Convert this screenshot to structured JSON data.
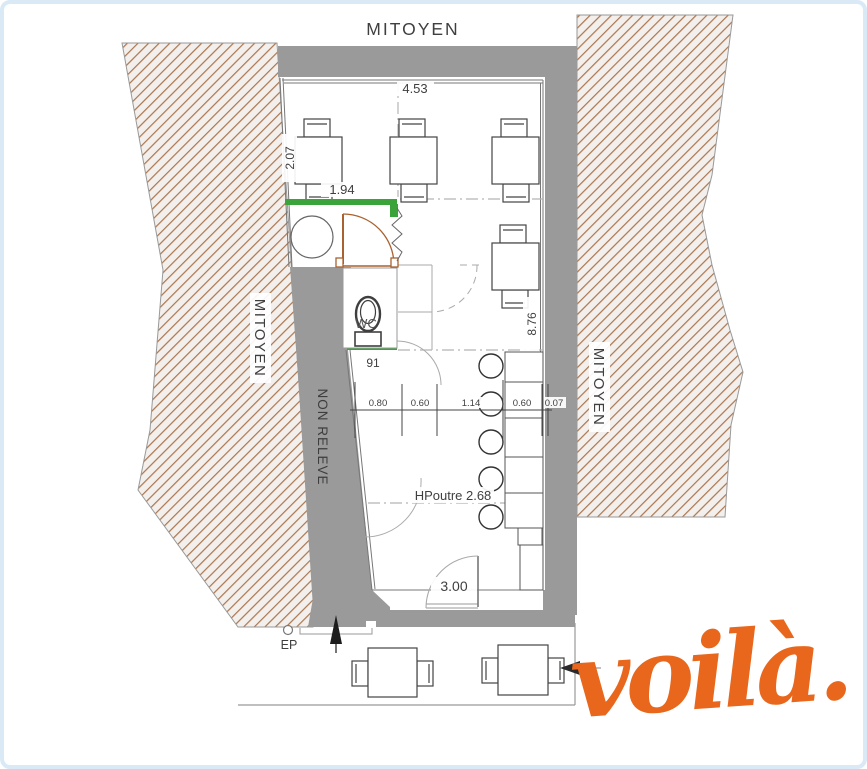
{
  "site_labels": {
    "mitoyen_top": "MITOYEN",
    "mitoyen_left": "MITOYEN",
    "mitoyen_right": "MITOYEN",
    "non_releve": "NON RELEVE"
  },
  "rooms": {
    "wc": "WC"
  },
  "annotations": {
    "hpoutre": "HPoutre 2.68",
    "ep": "EP"
  },
  "dimensions": {
    "top_span": "4.53",
    "left_top": "2.07",
    "green_wall": "1.94",
    "wc_width": "91",
    "right_span": "8.76",
    "entrance": "3.00",
    "chain": [
      "0.80",
      "0.60",
      "1.14",
      "0.60",
      "0.07"
    ]
  },
  "logo": {
    "text": "voilà.",
    "color": "#e8671c"
  },
  "colors": {
    "wall_gray": "#9a9a9a",
    "hatch_line": "#ab764f",
    "hatch_bg": "#f2efec",
    "green_wall": "#3aa43a",
    "door_brown": "#a9622f",
    "line_dark": "#3f3f3f",
    "line_light": "#aaaaaa",
    "frame_border": "#d9e9f6"
  }
}
